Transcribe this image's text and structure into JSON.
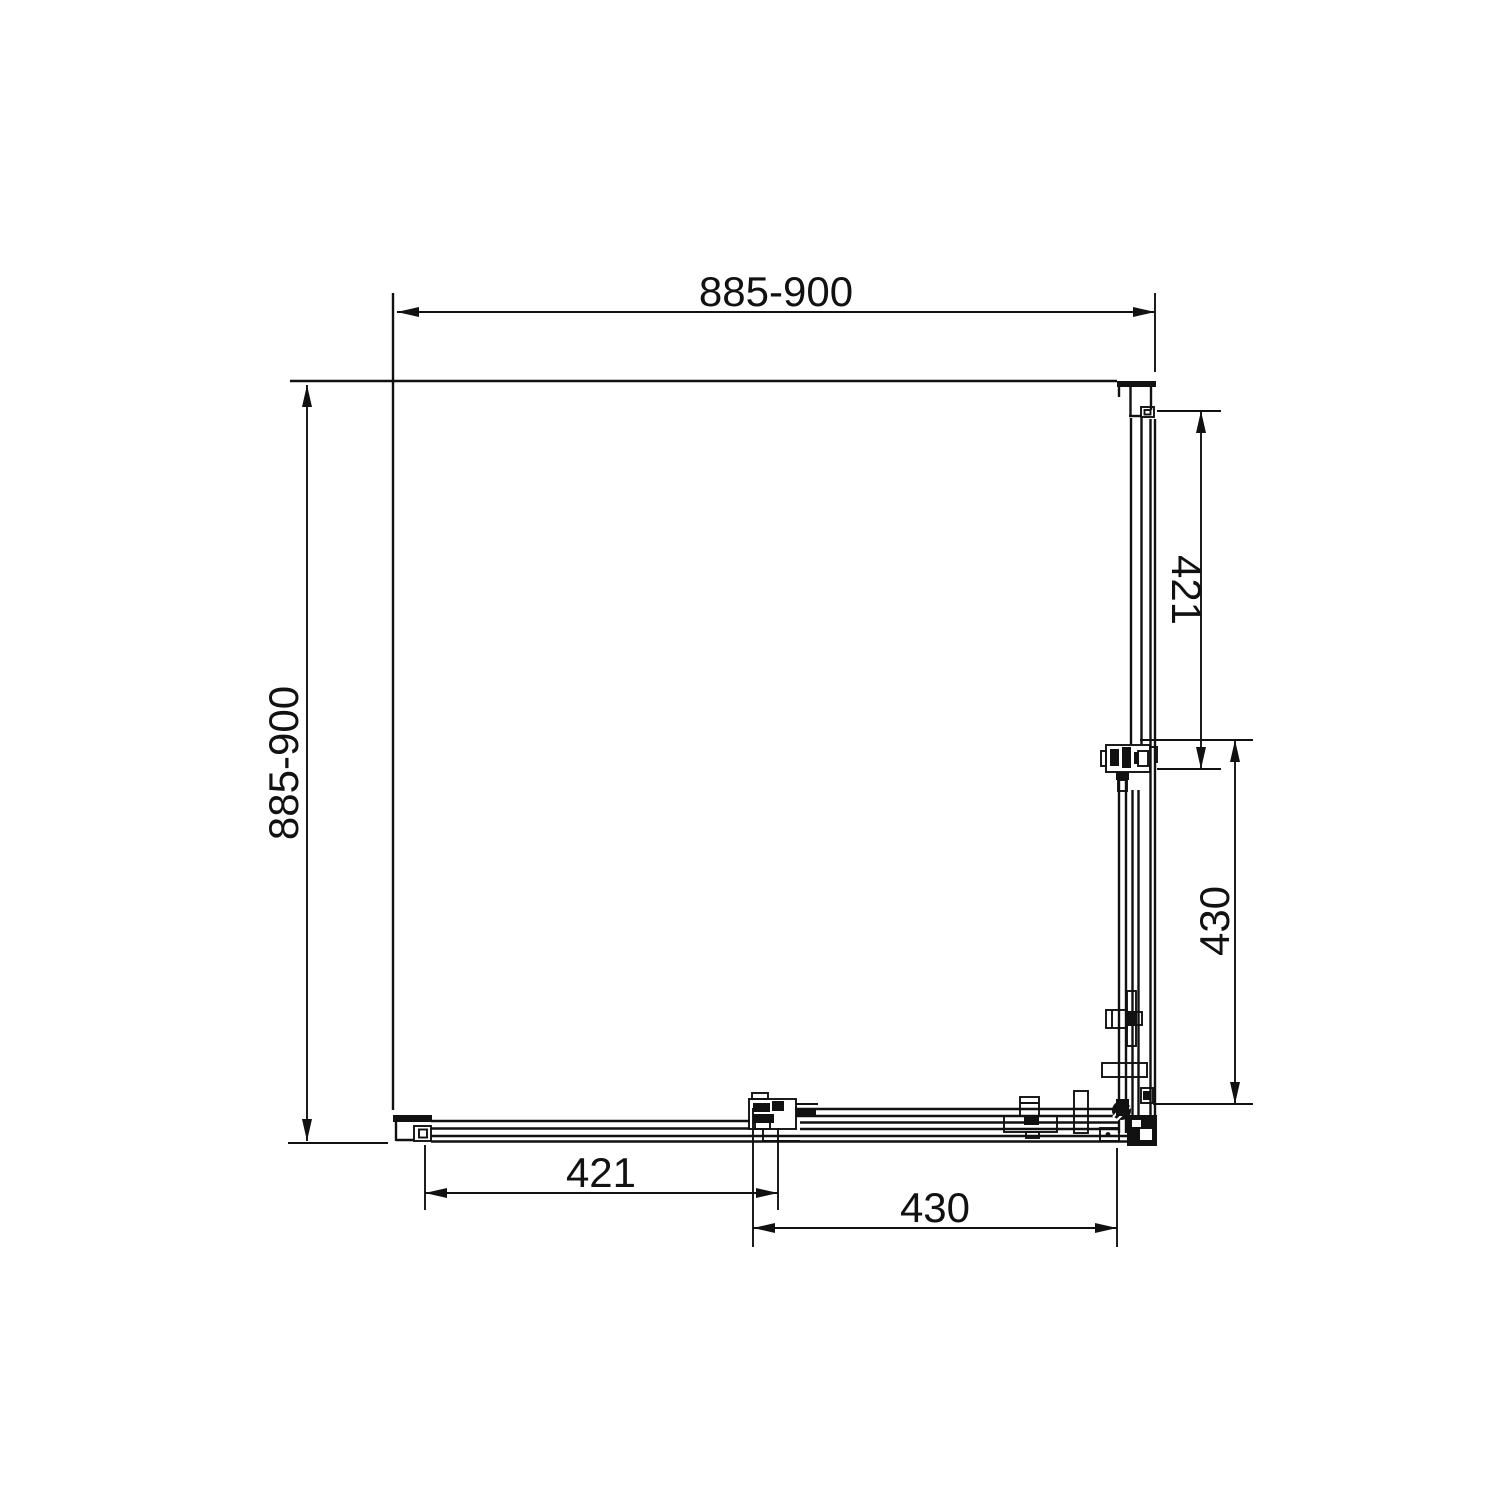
{
  "drawing": {
    "type": "technical-plan-view",
    "subject": "corner shower enclosure with two fixed panels and two sliding doors",
    "background": "#ffffff",
    "line_color": "#111111",
    "dims": {
      "top": "885-900",
      "left": "885-900",
      "right_fixed": "421",
      "right_door": "430",
      "bottom_fixed": "421",
      "bottom_door": "430"
    }
  }
}
